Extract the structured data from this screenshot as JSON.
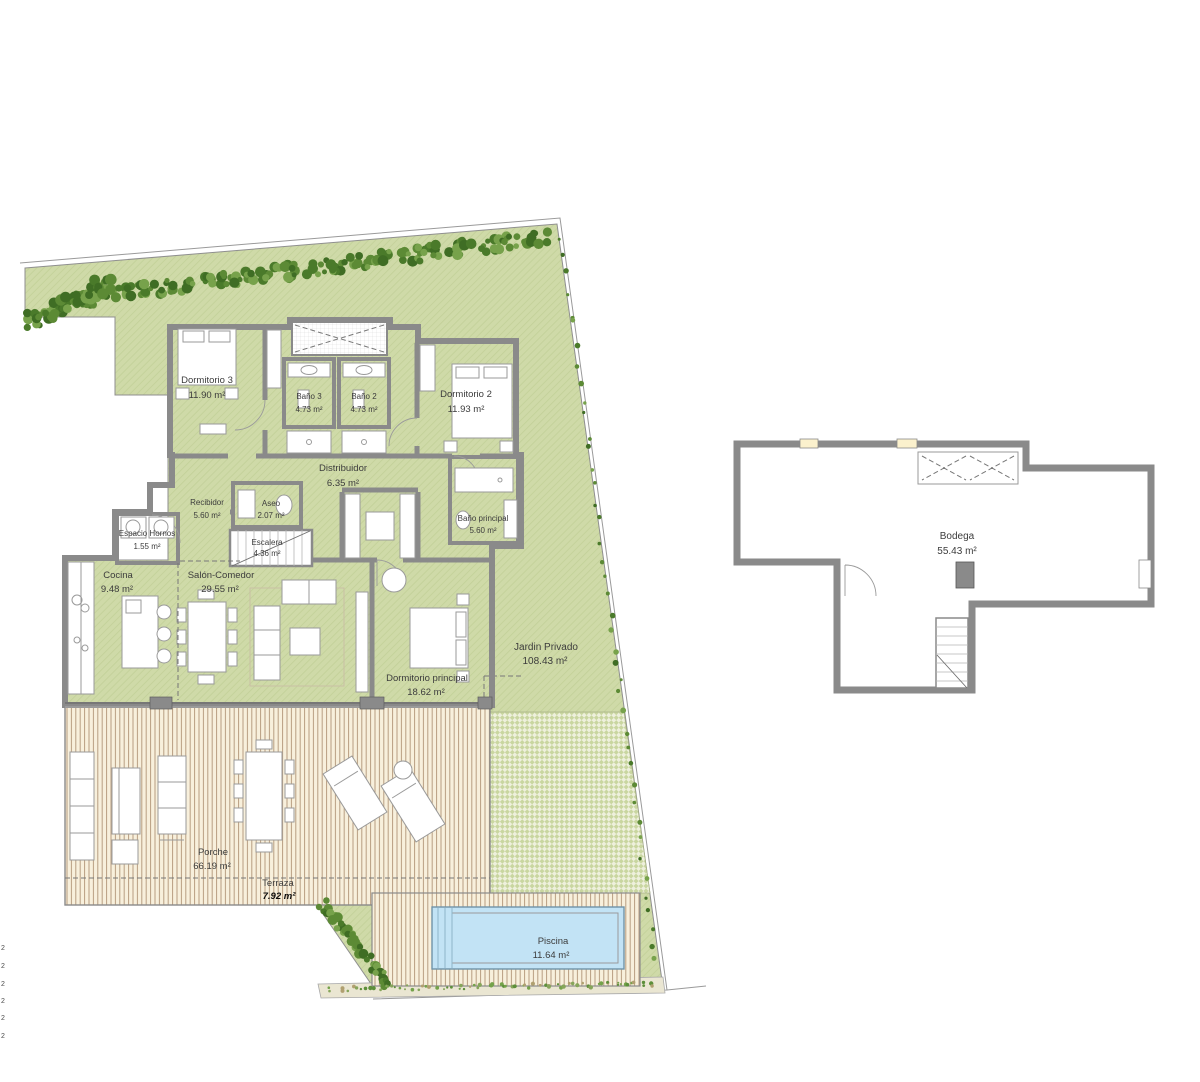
{
  "plan": {
    "rooms": [
      {
        "name": "Dormitorio 3",
        "area": "11.90 m²"
      },
      {
        "name": "Baño 3",
        "area": "4.73 m²"
      },
      {
        "name": "Baño 2",
        "area": "4.73 m²"
      },
      {
        "name": "Dormitorio 2",
        "area": "11.93 m²"
      },
      {
        "name": "Distribuidor",
        "area": "6.35 m²"
      },
      {
        "name": "Recibidor",
        "area": "5.60 m²"
      },
      {
        "name": "Aseo",
        "area": "2.07 m²"
      },
      {
        "name": "Escalera",
        "area": "4.36 m²"
      },
      {
        "name": "Baño principal",
        "area": "5.60 m²"
      },
      {
        "name": "Espacio Hornos",
        "area": "1.55 m²"
      },
      {
        "name": "Cocina",
        "area": "9.48 m²"
      },
      {
        "name": "Salón-Comedor",
        "area": "29.55 m²"
      },
      {
        "name": "Dormitorio principal",
        "area": "18.62 m²"
      },
      {
        "name": "Jardin Privado",
        "area": "108.43 m²"
      },
      {
        "name": "Porche",
        "area": "66.19 m²"
      },
      {
        "name": "Terraza",
        "area": "7.92 m²"
      },
      {
        "name": "Piscina",
        "area": "11.64 m²"
      },
      {
        "name": "Bodega",
        "area": "55.43 m²"
      }
    ],
    "margin_marks": [
      "2",
      "2",
      "2",
      "2",
      "2",
      "2"
    ],
    "colors": {
      "garden": "#cfdaa8",
      "room": "#fbf1cd",
      "wall": "#8a8a8a",
      "tile": "#dedede",
      "pool": "#c2e3f5",
      "deck": "#f8f0dc",
      "deck_line": "#b89e81",
      "hedge": "#46722a"
    }
  }
}
